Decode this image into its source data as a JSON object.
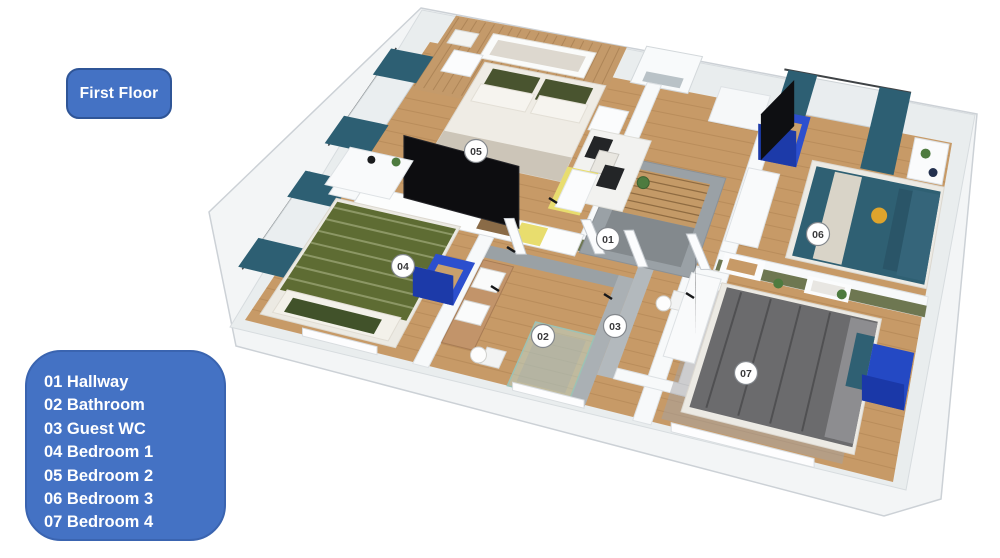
{
  "title_badge": {
    "label": "First Floor"
  },
  "legend": {
    "items": [
      {
        "label": "01 Hallway"
      },
      {
        "label": "02 Bathroom"
      },
      {
        "label": "03 Guest WC"
      },
      {
        "label": "04 Bedroom 1"
      },
      {
        "label": "05 Bedroom 2"
      },
      {
        "label": "06 Bedroom 3"
      },
      {
        "label": "07 Bedroom 4"
      }
    ]
  },
  "plan": {
    "markers": [
      {
        "id": "01",
        "x": 608,
        "y": 239
      },
      {
        "id": "02",
        "x": 543,
        "y": 336
      },
      {
        "id": "03",
        "x": 615,
        "y": 326
      },
      {
        "id": "04",
        "x": 403,
        "y": 266
      },
      {
        "id": "05",
        "x": 476,
        "y": 151
      },
      {
        "id": "06",
        "x": 818,
        "y": 234
      },
      {
        "id": "07",
        "x": 746,
        "y": 373
      }
    ]
  },
  "colors": {
    "accent_blue": "#4472C4",
    "accent_blue_border": "#2F5597",
    "floor_wood": "#C79A67",
    "wood_panel": "#C49A6A",
    "wall_white": "#F5F6F7",
    "teal_curtain": "#2D5F73",
    "olive_wall": "#6E7751",
    "furniture_blue": "#2C4FCE",
    "stair_gray": "#9AA1A6",
    "yellow_accent": "#E8DD6E",
    "bed_gray": "#6B6B6D",
    "bed_teal": "#2F6073",
    "bed_green": "#5E6C33"
  }
}
